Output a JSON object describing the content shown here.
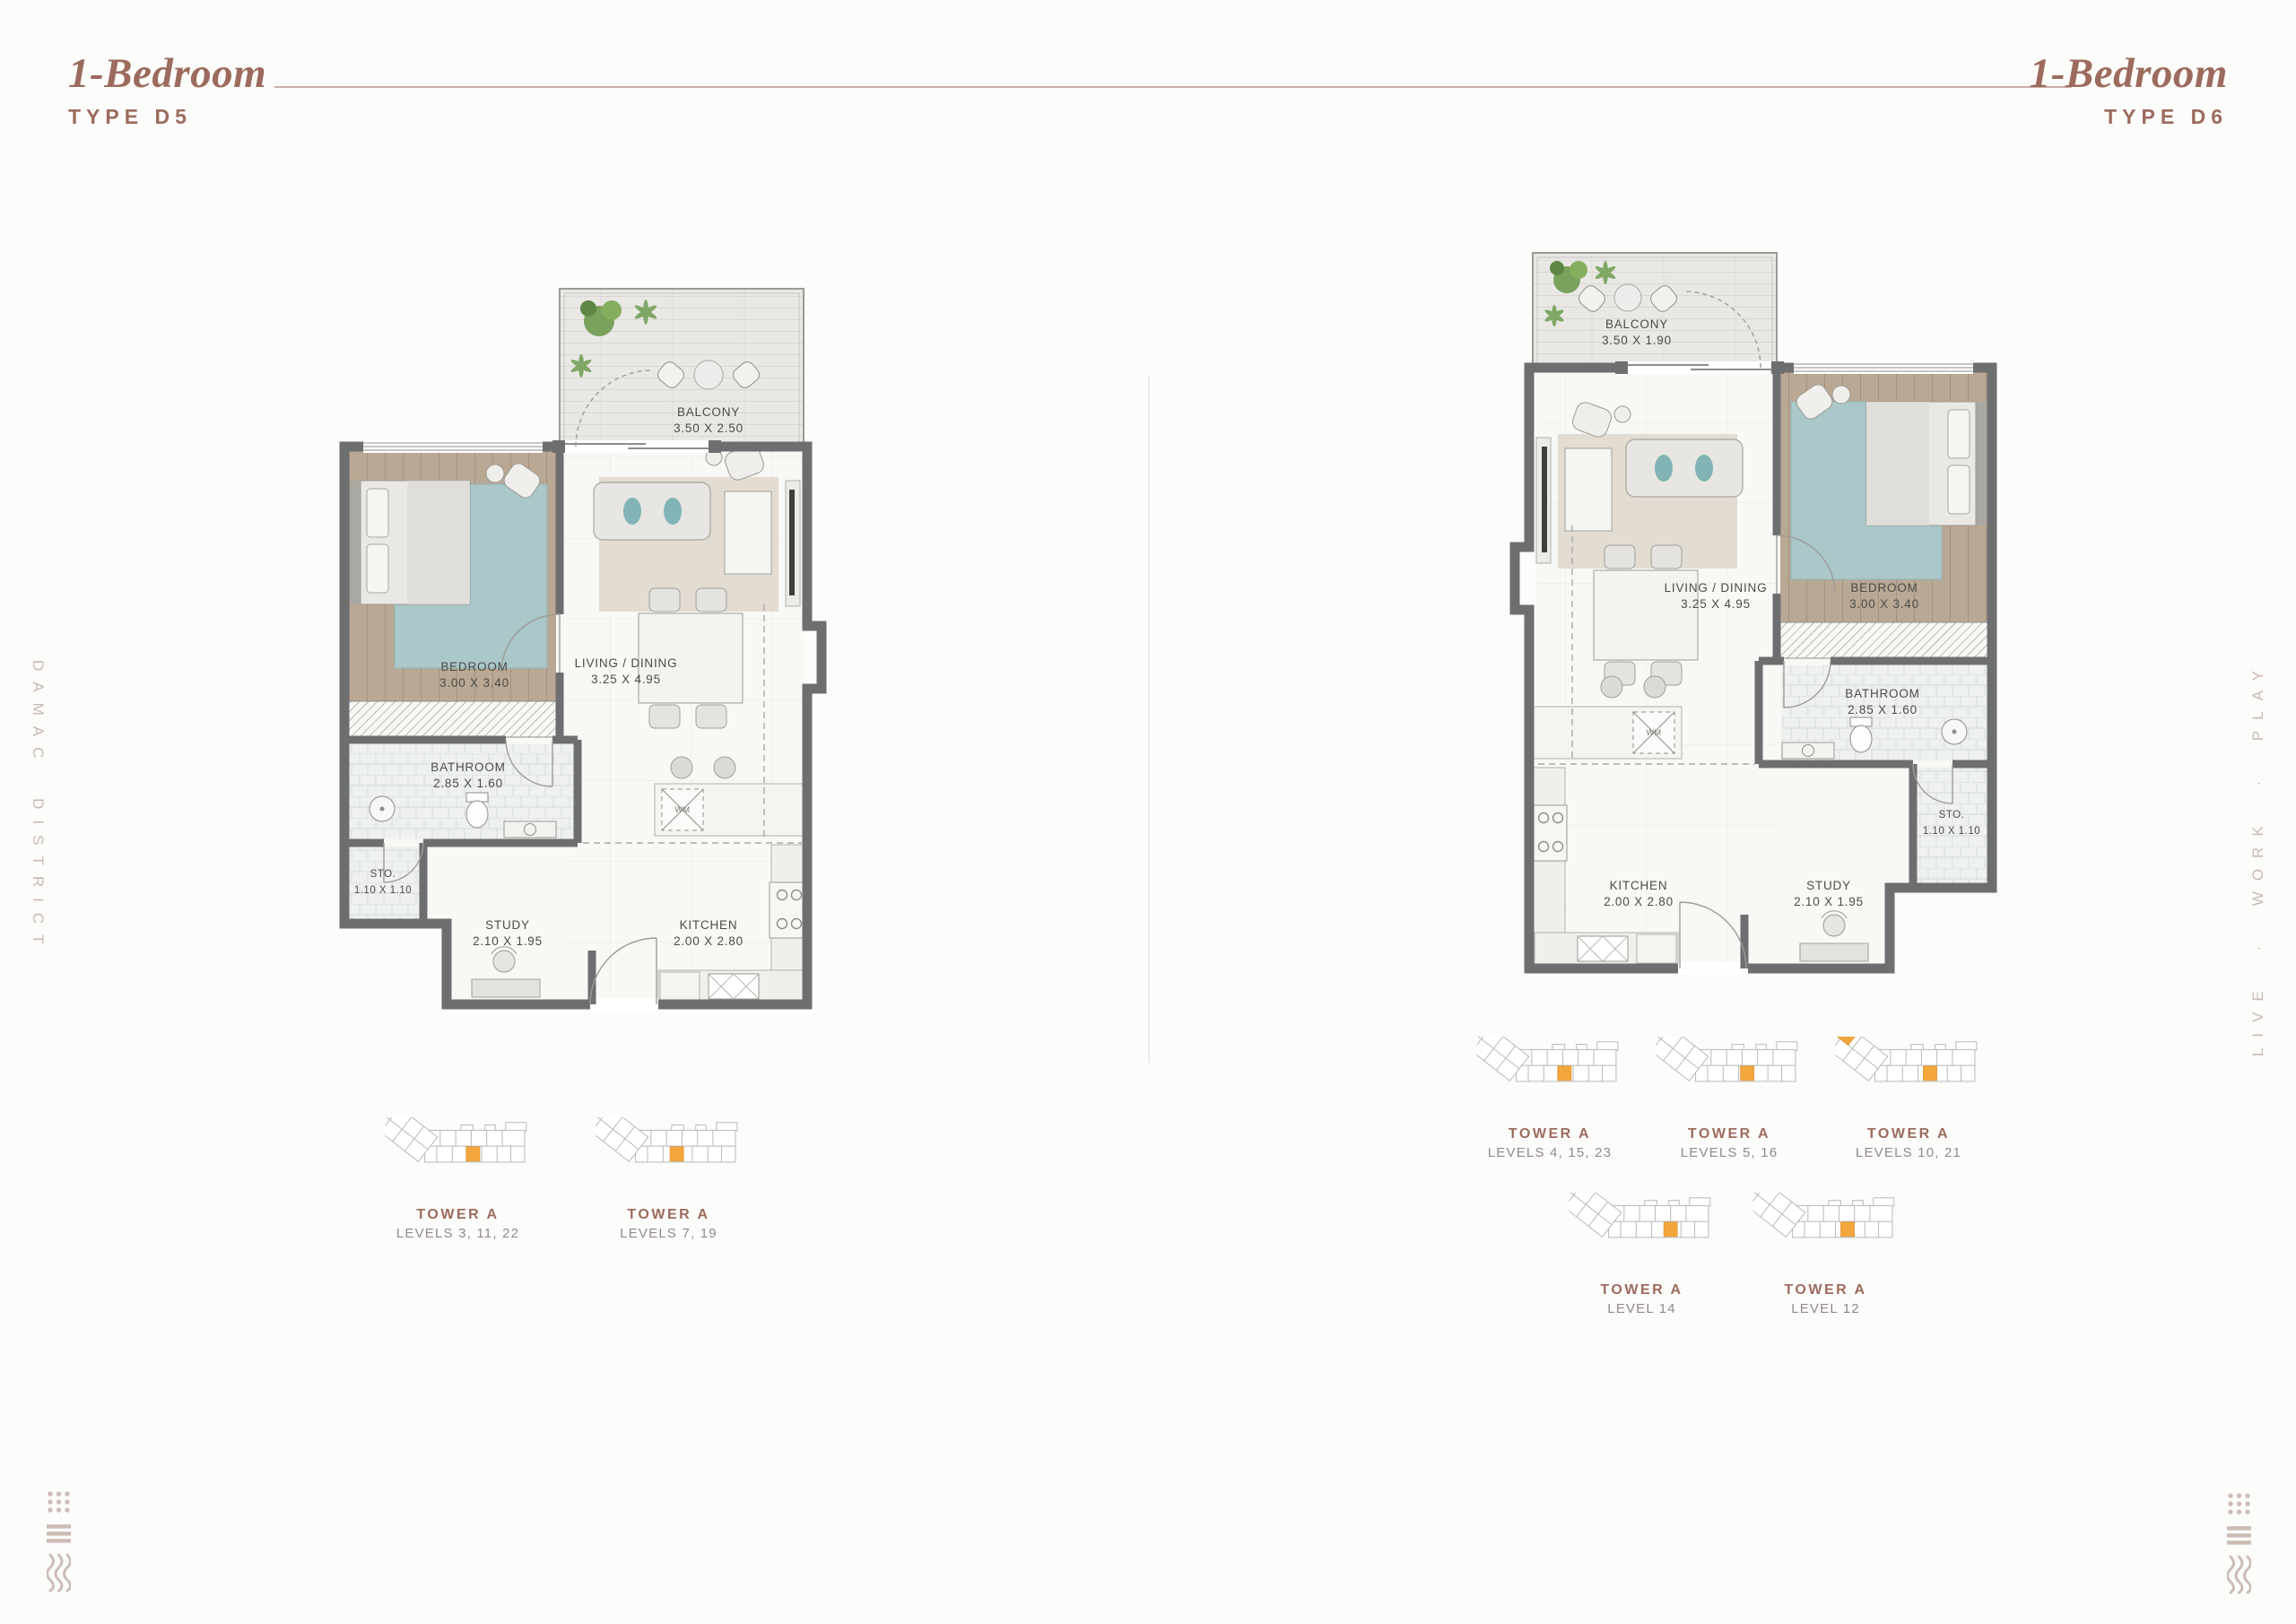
{
  "header": {
    "left": {
      "title": "1-Bedroom",
      "type": "TYPE D5"
    },
    "right": {
      "title": "1-Bedroom",
      "type": "TYPE D6"
    }
  },
  "side": {
    "left": "DAMAC DISTRICT",
    "right": "LIVE · WORK · PLAY"
  },
  "plans": {
    "d5": {
      "balcony": {
        "name": "BALCONY",
        "dims": "3.50 X 2.50"
      },
      "bedroom": {
        "name": "BEDROOM",
        "dims": "3.00 X 3.40"
      },
      "living": {
        "name": "LIVING / DINING",
        "dims": "3.25 X 4.95"
      },
      "bathroom": {
        "name": "BATHROOM",
        "dims": "2.85 X 1.60"
      },
      "sto": {
        "name": "STO.",
        "dims": "1.10 X 1.10"
      },
      "study": {
        "name": "STUDY",
        "dims": "2.10 X 1.95"
      },
      "kitchen": {
        "name": "KITCHEN",
        "dims": "2.00 X 2.80"
      },
      "wm": "WM"
    },
    "d6": {
      "balcony": {
        "name": "BALCONY",
        "dims": "3.50 X 1.90"
      },
      "bedroom": {
        "name": "BEDROOM",
        "dims": "3.00 X 3.40"
      },
      "living": {
        "name": "LIVING / DINING",
        "dims": "3.25 X 4.95"
      },
      "bathroom": {
        "name": "BATHROOM",
        "dims": "2.85 X 1.60"
      },
      "sto": {
        "name": "STO.",
        "dims": "1.10 X 1.10"
      },
      "study": {
        "name": "STUDY",
        "dims": "2.10 X 1.95"
      },
      "kitchen": {
        "name": "KITCHEN",
        "dims": "2.00 X 2.80"
      },
      "wm": "WM"
    }
  },
  "towers": {
    "d5": [
      {
        "name": "TOWER A",
        "levels": "LEVELS 3, 11, 22"
      },
      {
        "name": "TOWER A",
        "levels": "LEVELS 7, 19"
      }
    ],
    "d6": [
      {
        "name": "TOWER A",
        "levels": "LEVELS 4, 15, 23"
      },
      {
        "name": "TOWER A",
        "levels": "LEVELS 5, 16"
      },
      {
        "name": "TOWER A",
        "levels": "LEVELS 10, 21"
      },
      {
        "name": "TOWER A",
        "levels": "LEVEL 14"
      },
      {
        "name": "TOWER A",
        "levels": "LEVEL 12"
      }
    ]
  },
  "colors": {
    "accent": "#9c6b5e",
    "rule": "#c7aea7",
    "levels_text": "#93898a",
    "side_text": "#c9b8b1",
    "wall": "#6d6e70",
    "unit_highlight": "#f2a63b"
  }
}
